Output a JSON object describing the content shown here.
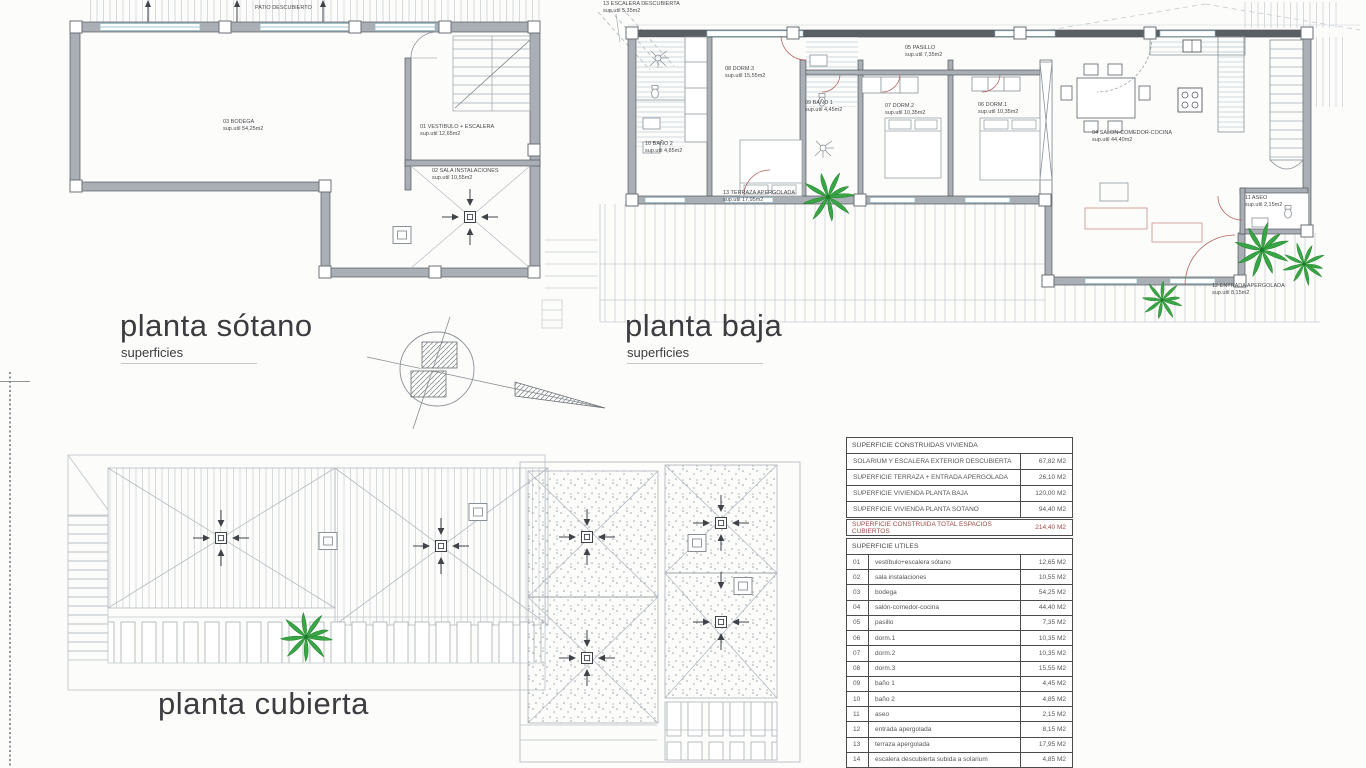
{
  "titles": {
    "sotano": {
      "title": "planta sótano",
      "subtitle": "superficies"
    },
    "baja": {
      "title": "planta baja",
      "subtitle": "superficies"
    },
    "cubierta": {
      "title": "planta cubierta"
    }
  },
  "plan_sotano": {
    "patio": "PATIO DESCUBIERTO",
    "rooms": [
      {
        "name": "03 BODEGA",
        "area": "sup.util 54,25m2"
      },
      {
        "name": "01 VESTIBULO + ESCALERA",
        "area": "sup.util 12,65m2"
      },
      {
        "name": "02 SALA INSTALACIONES",
        "area": "sup.util 10,55m2"
      }
    ]
  },
  "plan_baja": {
    "rooms": [
      {
        "name": "13 ESCALERA DESCUBIERTA",
        "area": "sup.util 5,35m2"
      },
      {
        "name": "08 DORM.3",
        "area": "sup.util 15,55m2"
      },
      {
        "name": "10 BAÑO 2",
        "area": "sup.util 4,85m2"
      },
      {
        "name": "09 BAÑO 1",
        "area": "sup.util 4,45m2"
      },
      {
        "name": "05 PASILLO",
        "area": "sup.util 7,35m2"
      },
      {
        "name": "07 DORM.2",
        "area": "sup.util 10,35m2"
      },
      {
        "name": "06 DORM.1",
        "area": "sup.util 10,35m2"
      },
      {
        "name": "04 SALON-COMEDOR-COCINA",
        "area": "sup.util 44,40m2"
      },
      {
        "name": "11 ASEO",
        "area": "sup.util 2,15m2"
      },
      {
        "name": "13 TERRAZA APERGOLADA",
        "area": "sup.util 17,95m2"
      },
      {
        "name": "12 ENTRADA APERGOLADA",
        "area": "sup.util 8,15m2"
      }
    ]
  },
  "tables": {
    "construidas": {
      "header": "SUPERFICIE CONSTRUIDAS VIVIENDA",
      "rows": [
        {
          "label": "SOLARIUM Y ESCALERA EXTERIOR DESCUBIERTA",
          "value": "67,82 M2"
        },
        {
          "label": "SUPERFICIE TERRAZA + ENTRADA APERGOLADA",
          "value": "26,10 M2"
        },
        {
          "label": "SUPERFICIE VIVIENDA PLANTA BAJA",
          "value": "120,00 M2"
        },
        {
          "label": "SUPERFICIE VIVIENDA PLANTA SOTANO",
          "value": "94,40 M2"
        }
      ],
      "total": {
        "label": "SUPERFICIE CONSTRUIDA TOTAL ESPACIOS CUBIERTOS",
        "value": "214,40 M2"
      }
    },
    "utiles": {
      "header": "SUPERFICIE UTILES",
      "rows": [
        {
          "num": "01",
          "label": "vestíbulo+escalera sótano",
          "value": "12,65 M2"
        },
        {
          "num": "02",
          "label": "sala instalaciones",
          "value": "10,55 M2"
        },
        {
          "num": "03",
          "label": "bodega",
          "value": "54,25 M2"
        },
        {
          "num": "04",
          "label": "salón-comedor-cocina",
          "value": "44,40 M2"
        },
        {
          "num": "05",
          "label": "pasillo",
          "value": "7,35 M2"
        },
        {
          "num": "06",
          "label": "dorm.1",
          "value": "10,35 M2"
        },
        {
          "num": "07",
          "label": "dorm.2",
          "value": "10,35 M2"
        },
        {
          "num": "08",
          "label": "dorm.3",
          "value": "15,55 M2"
        },
        {
          "num": "09",
          "label": "baño 1",
          "value": "4,45 M2"
        },
        {
          "num": "10",
          "label": "baño 2",
          "value": "4,85 M2"
        },
        {
          "num": "11",
          "label": "aseo",
          "value": "2,15 M2"
        },
        {
          "num": "12",
          "label": "entrada apergolada",
          "value": "8,15 M2"
        },
        {
          "num": "13",
          "label": "terraza apergolada",
          "value": "17,95 M2"
        },
        {
          "num": "14",
          "label": "escalera descubierta subida a solarium",
          "value": "4,85 M2"
        }
      ]
    }
  },
  "colors": {
    "wall_gray": "#a9afb4",
    "wall_dark": "#5a5f64",
    "line_light": "#c6ccd0",
    "palm_green": "#39a546",
    "door_red": "#b5635c",
    "total_red": "#9e4a44",
    "text_dark": "#4a4a4e"
  }
}
